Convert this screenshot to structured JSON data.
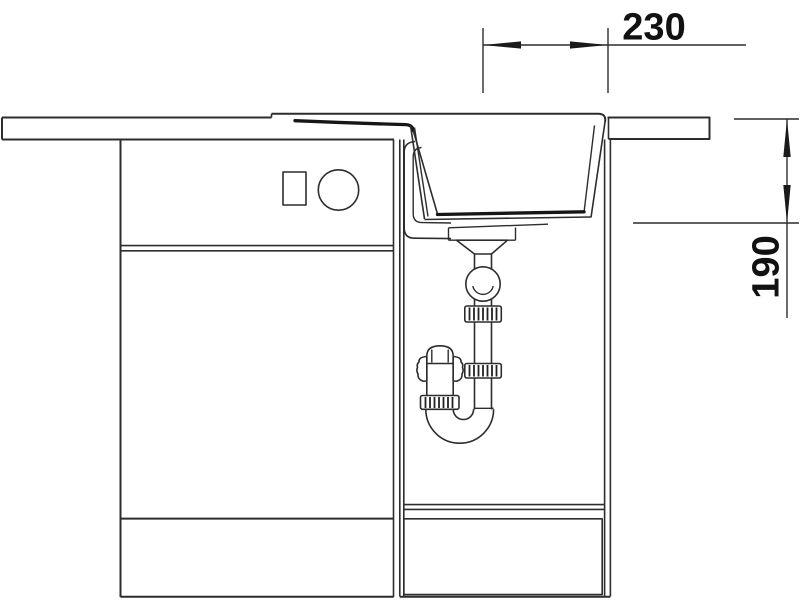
{
  "drawing": {
    "type": "technical-installation-drawing",
    "dimensions": {
      "drain_offset": {
        "value": "230",
        "orientation": "horizontal"
      },
      "bowl_depth": {
        "value": "190",
        "orientation": "vertical"
      }
    },
    "components": [
      "countertop",
      "sink-rim",
      "drainboard",
      "sink-bowl",
      "drain-flange",
      "drain-funnel",
      "ball-joint",
      "coupling-nut",
      "p-trap-siphon",
      "left-base-cabinet",
      "drawer-front",
      "door-front",
      "sink-base-cabinet",
      "plinth",
      "switch-square",
      "knob-circle"
    ],
    "colors": {
      "background": "#ffffff",
      "line": "#2d2d2d",
      "thick_line": "#161616",
      "text": "#111111"
    }
  }
}
